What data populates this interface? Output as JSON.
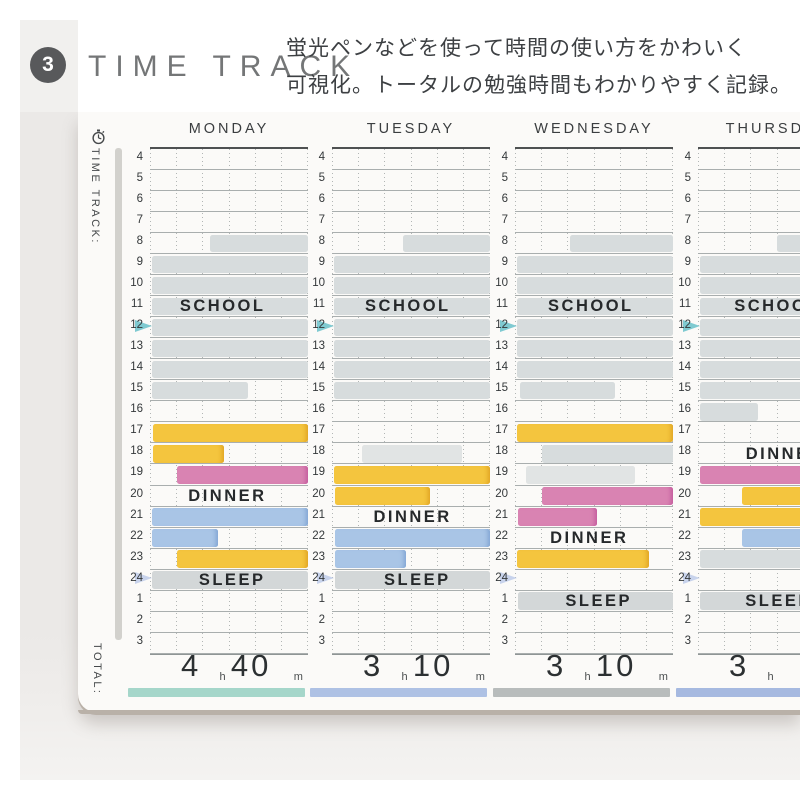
{
  "header": {
    "badge": "3",
    "title": "TIME TRACK",
    "description": [
      "蛍光ペンなどを使って時間の使い方をかわいく",
      "可視化。トータルの勉強時間もわかりやすく記録。"
    ]
  },
  "sidebar": {
    "track_label": "TIME TRACK:",
    "total_label": "TOTAL:"
  },
  "timetable": {
    "hours": [
      "4",
      "5",
      "6",
      "7",
      "8",
      "9",
      "10",
      "11",
      "12",
      "13",
      "14",
      "15",
      "16",
      "17",
      "18",
      "19",
      "20",
      "21",
      "22",
      "23",
      "24",
      "1",
      "2",
      "3"
    ],
    "noon_hour": "12",
    "midnight_hour": "24",
    "unit_hour": "h",
    "unit_minute": "m",
    "columns": [
      {
        "day": "MONDAY",
        "underline": "#a5d6ca",
        "total_h": "4",
        "total_m": "40",
        "labels": [
          {
            "text": "SCHOOL",
            "row": 7,
            "center": 46
          },
          {
            "text": "DINNER",
            "row": 16,
            "center": 49
          },
          {
            "text": "SLEEP",
            "row": 20,
            "center": 52
          }
        ],
        "bars": [
          {
            "row": 4,
            "start": 38,
            "end": 100,
            "color": "gray"
          },
          {
            "row": 5,
            "start": 1,
            "end": 100,
            "color": "gray"
          },
          {
            "row": 6,
            "start": 1,
            "end": 100,
            "color": "gray"
          },
          {
            "row": 7,
            "start": 1,
            "end": 100,
            "color": "gray"
          },
          {
            "row": 8,
            "start": 1,
            "end": 100,
            "color": "gray"
          },
          {
            "row": 9,
            "start": 1,
            "end": 100,
            "color": "gray"
          },
          {
            "row": 10,
            "start": 1,
            "end": 100,
            "color": "gray"
          },
          {
            "row": 11,
            "start": 1,
            "end": 62,
            "color": "gray"
          },
          {
            "row": 13,
            "start": 2,
            "end": 100,
            "color": "yellow"
          },
          {
            "row": 14,
            "start": 2,
            "end": 47,
            "color": "yellow"
          },
          {
            "row": 15,
            "start": 17,
            "end": 100,
            "color": "pink"
          },
          {
            "row": 17,
            "start": 1,
            "end": 100,
            "color": "blue"
          },
          {
            "row": 18,
            "start": 1,
            "end": 43,
            "color": "blue"
          },
          {
            "row": 19,
            "start": 17,
            "end": 100,
            "color": "yellow"
          },
          {
            "row": 20,
            "start": 1,
            "end": 100,
            "color": "sleep"
          }
        ]
      },
      {
        "day": "TUESDAY",
        "underline": "#aec1e4",
        "total_h": "3",
        "total_m": "10",
        "labels": [
          {
            "text": "SCHOOL",
            "row": 7,
            "center": 48
          },
          {
            "text": "DINNER",
            "row": 17,
            "center": 51
          },
          {
            "text": "SLEEP",
            "row": 20,
            "center": 54
          }
        ],
        "bars": [
          {
            "row": 4,
            "start": 45,
            "end": 100,
            "color": "gray"
          },
          {
            "row": 5,
            "start": 1,
            "end": 100,
            "color": "gray"
          },
          {
            "row": 6,
            "start": 1,
            "end": 100,
            "color": "gray"
          },
          {
            "row": 7,
            "start": 1,
            "end": 100,
            "color": "gray"
          },
          {
            "row": 8,
            "start": 1,
            "end": 100,
            "color": "gray"
          },
          {
            "row": 9,
            "start": 1,
            "end": 100,
            "color": "gray"
          },
          {
            "row": 10,
            "start": 1,
            "end": 100,
            "color": "gray"
          },
          {
            "row": 11,
            "start": 1,
            "end": 100,
            "color": "gray"
          },
          {
            "row": 14,
            "start": 19,
            "end": 82,
            "color": "graylight"
          },
          {
            "row": 15,
            "start": 1,
            "end": 100,
            "color": "yellow"
          },
          {
            "row": 16,
            "start": 2,
            "end": 62,
            "color": "yellow"
          },
          {
            "row": 18,
            "start": 2,
            "end": 100,
            "color": "blue"
          },
          {
            "row": 19,
            "start": 2,
            "end": 47,
            "color": "blue"
          },
          {
            "row": 20,
            "start": 2,
            "end": 100,
            "color": "sleep"
          }
        ]
      },
      {
        "day": "WEDNESDAY",
        "underline": "#b8bcbc",
        "total_h": "3",
        "total_m": "10",
        "labels": [
          {
            "text": "SCHOOL",
            "row": 7,
            "center": 48
          },
          {
            "text": "DINNER",
            "row": 18,
            "center": 47
          },
          {
            "text": "SLEEP",
            "row": 21,
            "center": 53
          }
        ],
        "bars": [
          {
            "row": 4,
            "start": 35,
            "end": 100,
            "color": "gray"
          },
          {
            "row": 5,
            "start": 1,
            "end": 100,
            "color": "gray"
          },
          {
            "row": 6,
            "start": 1,
            "end": 100,
            "color": "gray"
          },
          {
            "row": 7,
            "start": 1,
            "end": 100,
            "color": "gray"
          },
          {
            "row": 8,
            "start": 1,
            "end": 100,
            "color": "gray"
          },
          {
            "row": 9,
            "start": 1,
            "end": 100,
            "color": "gray"
          },
          {
            "row": 10,
            "start": 1,
            "end": 100,
            "color": "gray"
          },
          {
            "row": 11,
            "start": 3,
            "end": 63,
            "color": "gray"
          },
          {
            "row": 13,
            "start": 1,
            "end": 100,
            "color": "yellow"
          },
          {
            "row": 14,
            "start": 17,
            "end": 100,
            "color": "gray"
          },
          {
            "row": 15,
            "start": 7,
            "end": 76,
            "color": "graylight"
          },
          {
            "row": 16,
            "start": 17,
            "end": 100,
            "color": "pink"
          },
          {
            "row": 17,
            "start": 2,
            "end": 52,
            "color": "pink"
          },
          {
            "row": 19,
            "start": 1,
            "end": 85,
            "color": "yellow"
          },
          {
            "row": 21,
            "start": 2,
            "end": 100,
            "color": "sleep"
          }
        ]
      },
      {
        "day": "THURSDAY",
        "underline": "#a6b9e0",
        "total_h": "3",
        "total_m": "",
        "labels": [
          {
            "text": "SCHOOL",
            "row": 7,
            "center": 50
          },
          {
            "text": "DINNER",
            "row": 14,
            "center": 55
          },
          {
            "text": "SLEEP",
            "row": 21,
            "center": 51
          }
        ],
        "bars": [
          {
            "row": 4,
            "start": 50,
            "end": 100,
            "color": "gray"
          },
          {
            "row": 5,
            "start": 1,
            "end": 100,
            "color": "gray"
          },
          {
            "row": 6,
            "start": 1,
            "end": 100,
            "color": "gray"
          },
          {
            "row": 7,
            "start": 1,
            "end": 100,
            "color": "gray"
          },
          {
            "row": 8,
            "start": 1,
            "end": 100,
            "color": "gray"
          },
          {
            "row": 9,
            "start": 1,
            "end": 100,
            "color": "gray"
          },
          {
            "row": 10,
            "start": 1,
            "end": 100,
            "color": "gray"
          },
          {
            "row": 11,
            "start": 1,
            "end": 100,
            "color": "gray"
          },
          {
            "row": 12,
            "start": 1,
            "end": 38,
            "color": "gray"
          },
          {
            "row": 15,
            "start": 1,
            "end": 100,
            "color": "pink"
          },
          {
            "row": 16,
            "start": 28,
            "end": 100,
            "color": "yellow"
          },
          {
            "row": 17,
            "start": 1,
            "end": 100,
            "color": "yellow"
          },
          {
            "row": 18,
            "start": 28,
            "end": 100,
            "color": "blue"
          },
          {
            "row": 19,
            "start": 1,
            "end": 100,
            "color": "gray"
          },
          {
            "row": 21,
            "start": 1,
            "end": 100,
            "color": "sleep"
          }
        ]
      }
    ]
  },
  "colors": {
    "yellow": "#f4c53e",
    "pink": "#d983b2",
    "blue": "#a9c5e6",
    "school_gray": "#d7dcdd",
    "school_gray_light": "#e1e4e4",
    "sleep_gray": "#d3d7d8",
    "flag_noon": "#7fcad1",
    "flag_midnight": "#bcc9e8",
    "badge": "#58595b"
  }
}
